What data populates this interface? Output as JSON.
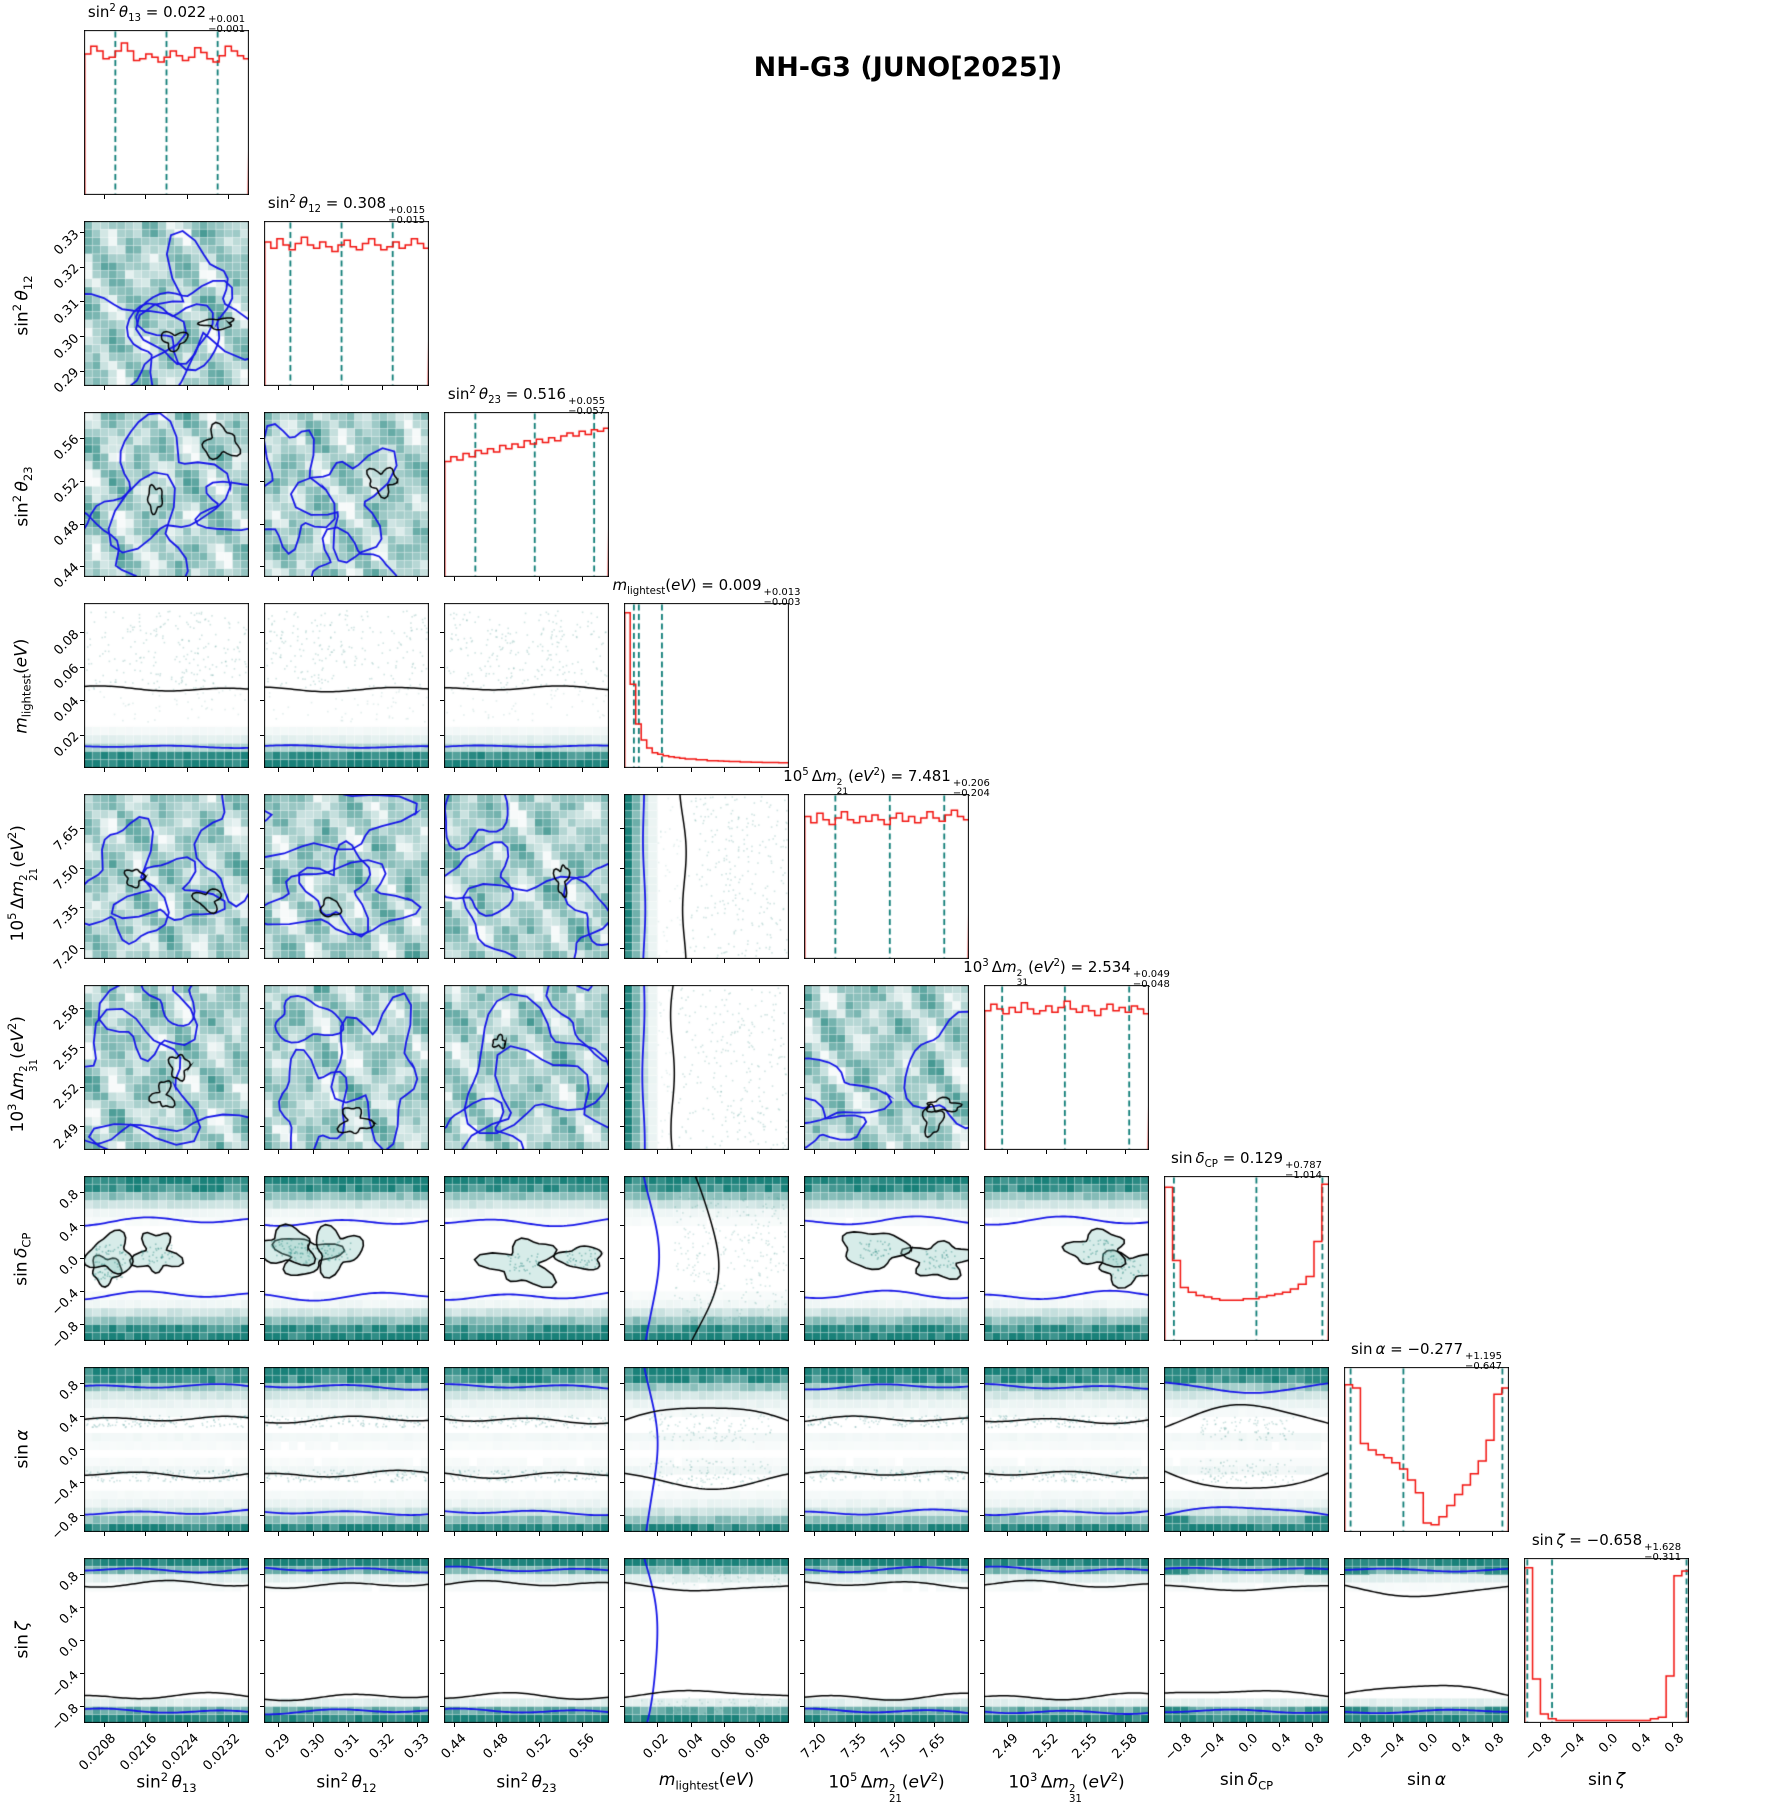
{
  "figure": {
    "title": "NH-G3 (JUNO[2025])"
  },
  "chart_data": {
    "type": "corner_plot",
    "title": "NH-G3 (JUNO[2025])",
    "n_params": 9,
    "legend": "none",
    "grid": "per-panel pixel grid",
    "colors": {
      "hist_line": "#f2120e",
      "quantile_dash": "#0e7d77",
      "contour_outer": "#1717e8",
      "contour_inner": "#000000",
      "density_dark": "#0d7a72",
      "scatter": "rgba(23,125,117,0.30)",
      "background": "#ffffff"
    },
    "groups": {
      "mosaic_params": [
        0,
        1,
        2,
        4,
        5
      ],
      "mass_param": 3,
      "sine_params": [
        6,
        7,
        8
      ]
    },
    "parameters": [
      {
        "key": "sin2theta13",
        "label_text": "sin²θ13",
        "label_html": "sin<sup>2</sup>&#8201;<i>θ</i><sub>13</sub>",
        "estimate": "0.022",
        "plus": "+0.001",
        "minus": "−0.001",
        "range": [
          0.0204,
          0.0236
        ],
        "tick_labels": [
          "0.0208",
          "0.0216",
          "0.0224",
          "0.0232"
        ],
        "tick_fracs": [
          0.125,
          0.375,
          0.625,
          0.875
        ],
        "quantile_fracs": [
          0.19,
          0.5,
          0.81
        ],
        "hist": [
          0.88,
          0.93,
          0.9,
          0.85,
          0.86,
          0.9,
          0.95,
          0.9,
          0.84,
          0.85,
          0.88,
          0.86,
          0.83,
          0.86,
          0.9,
          0.87,
          0.84,
          0.86,
          0.92,
          0.89,
          0.85,
          0.83,
          0.87,
          0.93,
          0.9,
          0.87,
          0.85
        ]
      },
      {
        "key": "sin2theta12",
        "label_text": "sin²θ12",
        "label_html": "sin<sup>2</sup>&#8201;<i>θ</i><sub>12</sub>",
        "estimate": "0.308",
        "plus": "+0.015",
        "minus": "−0.015",
        "range": [
          0.2855,
          0.3335
        ],
        "tick_labels": [
          "0.29",
          "0.30",
          "0.31",
          "0.32",
          "0.33"
        ],
        "tick_fracs": [
          0.09,
          0.3,
          0.51,
          0.72,
          0.93
        ],
        "quantile_fracs": [
          0.16,
          0.47,
          0.78
        ],
        "hist": [
          0.9,
          0.86,
          0.92,
          0.88,
          0.85,
          0.89,
          0.93,
          0.88,
          0.86,
          0.9,
          0.87,
          0.84,
          0.88,
          0.91,
          0.87,
          0.85,
          0.89,
          0.92,
          0.88,
          0.85,
          0.87,
          0.9,
          0.86,
          0.88,
          0.92,
          0.89,
          0.86
        ]
      },
      {
        "key": "sin2theta23",
        "label_text": "sin²θ23",
        "label_html": "sin<sup>2</sup>&#8201;<i>θ</i><sub>23</sub>",
        "estimate": "0.516",
        "plus": "+0.055",
        "minus": "−0.057",
        "range": [
          0.43,
          0.585
        ],
        "tick_labels": [
          "0.44",
          "0.48",
          "0.52",
          "0.56"
        ],
        "tick_fracs": [
          0.065,
          0.32,
          0.58,
          0.84
        ],
        "quantile_fracs": [
          0.19,
          0.55,
          0.91
        ],
        "hist": [
          0.72,
          0.75,
          0.73,
          0.77,
          0.75,
          0.79,
          0.77,
          0.8,
          0.78,
          0.82,
          0.8,
          0.83,
          0.81,
          0.85,
          0.83,
          0.86,
          0.84,
          0.87,
          0.85,
          0.88,
          0.9,
          0.88,
          0.91,
          0.89,
          0.92,
          0.91,
          0.93
        ]
      },
      {
        "key": "mlightest",
        "label_text": "m_lightest(eV)",
        "label_html": "<i>m</i><sub>lightest</sub>(<i>eV</i>)",
        "estimate": "0.009",
        "plus": "+0.013",
        "minus": "−0.003",
        "range": [
          0.0,
          0.097
        ],
        "tick_labels": [
          "0.02",
          "0.04",
          "0.06",
          "0.08"
        ],
        "tick_fracs": [
          0.2,
          0.41,
          0.61,
          0.82
        ],
        "quantile_fracs": [
          0.06,
          0.09,
          0.23
        ],
        "hist": [
          0.97,
          0.52,
          0.27,
          0.17,
          0.12,
          0.09,
          0.08,
          0.07,
          0.065,
          0.06,
          0.055,
          0.05,
          0.05,
          0.045,
          0.045,
          0.04,
          0.04,
          0.038,
          0.036,
          0.035,
          0.034,
          0.032,
          0.031,
          0.03,
          0.03,
          0.029,
          0.028,
          0.028,
          0.027,
          0.026
        ]
      },
      {
        "key": "dm221",
        "label_text": "10^5 Δm²21(eV²)",
        "label_html": "10<sup>5</sup>&#8201;Δ<i>m</i><span class=\"ss\"><span>2</span><span>21</span></span>(<i>eV</i><sup>2</sup>)",
        "estimate": "7.481",
        "plus": "+0.206",
        "minus": "−0.204",
        "range": [
          7.16,
          7.78
        ],
        "tick_labels": [
          "7.20",
          "7.35",
          "7.50",
          "7.65"
        ],
        "tick_fracs": [
          0.065,
          0.31,
          0.55,
          0.79
        ],
        "quantile_fracs": [
          0.19,
          0.52,
          0.85
        ],
        "hist": [
          0.89,
          0.85,
          0.91,
          0.87,
          0.84,
          0.88,
          0.92,
          0.87,
          0.85,
          0.89,
          0.86,
          0.9,
          0.87,
          0.84,
          0.88,
          0.91,
          0.86,
          0.89,
          0.85,
          0.88,
          0.92,
          0.88,
          0.86,
          0.9,
          0.93,
          0.89,
          0.87
        ]
      },
      {
        "key": "dm231",
        "label_text": "10^3 Δm²31(eV²)",
        "label_html": "10<sup>3</sup>&#8201;Δ<i>m</i><span class=\"ss\"><span>2</span><span>31</span></span>(<i>eV</i><sup>2</sup>)",
        "estimate": "2.534",
        "plus": "+0.049",
        "minus": "−0.048",
        "range": [
          2.4795,
          2.5905
        ],
        "tick_labels": [
          "2.49",
          "2.52",
          "2.55",
          "2.58"
        ],
        "tick_fracs": [
          0.14,
          0.38,
          0.62,
          0.86
        ],
        "quantile_fracs": [
          0.11,
          0.49,
          0.88
        ],
        "hist": [
          0.87,
          0.91,
          0.88,
          0.85,
          0.89,
          0.86,
          0.92,
          0.88,
          0.85,
          0.87,
          0.9,
          0.86,
          0.89,
          0.93,
          0.88,
          0.86,
          0.9,
          0.87,
          0.84,
          0.88,
          0.91,
          0.87,
          0.89,
          0.86,
          0.9,
          0.88,
          0.85
        ]
      },
      {
        "key": "sindcp",
        "label_text": "sin δCP",
        "label_html": "sin&#8201;<i>δ</i><sub>CP</sub>",
        "estimate": "0.129",
        "plus": "+0.787",
        "minus": "−1.014",
        "range": [
          -1.0,
          1.0
        ],
        "tick_labels": [
          "−0.8",
          "−0.4",
          "0.0",
          "0.4",
          "0.8"
        ],
        "tick_fracs": [
          0.1,
          0.3,
          0.5,
          0.7,
          0.9
        ],
        "quantile_fracs": [
          0.06,
          0.56,
          0.96
        ],
        "hist": [
          0.96,
          0.5,
          0.33,
          0.3,
          0.28,
          0.27,
          0.26,
          0.25,
          0.25,
          0.25,
          0.26,
          0.26,
          0.27,
          0.28,
          0.29,
          0.3,
          0.32,
          0.35,
          0.4,
          0.62,
          0.98
        ],
        "band_profile": [
          0.95,
          0.8,
          0.45,
          0.2,
          0.06,
          0.03,
          0.02,
          0.02,
          0.02,
          0.02,
          0.02,
          0.02,
          0.02,
          0.02,
          0.03,
          0.06,
          0.2,
          0.45,
          0.8,
          0.95
        ],
        "contours": {
          "blue": [
            0.45,
            -0.45
          ],
          "black": "blobs"
        }
      },
      {
        "key": "sinalpha",
        "label_text": "sin α",
        "label_html": "sin&#8201;<i>α</i>",
        "estimate": "−0.277",
        "plus": "+1.195",
        "minus": "−0.647",
        "range": [
          -1.0,
          1.0
        ],
        "tick_labels": [
          "−0.8",
          "−0.4",
          "0.0",
          "0.4",
          "0.8"
        ],
        "tick_fracs": [
          0.1,
          0.3,
          0.5,
          0.7,
          0.9
        ],
        "quantile_fracs": [
          0.04,
          0.36,
          0.96
        ],
        "hist": [
          0.92,
          0.9,
          0.55,
          0.51,
          0.48,
          0.46,
          0.43,
          0.39,
          0.32,
          0.24,
          0.05,
          0.04,
          0.09,
          0.16,
          0.23,
          0.29,
          0.36,
          0.44,
          0.57,
          0.86,
          0.9
        ],
        "band_profile": [
          0.92,
          0.8,
          0.4,
          0.18,
          0.08,
          0.04,
          0.02,
          0.02,
          0.05,
          0.03,
          0.02,
          0.03,
          0.06,
          0.02,
          0.02,
          0.04,
          0.08,
          0.2,
          0.45,
          0.9
        ],
        "contours": {
          "blue": [
            0.76,
            -0.76
          ],
          "black": [
            0.36,
            -0.3
          ]
        }
      },
      {
        "key": "sinzeta",
        "label_text": "sin ζ",
        "label_html": "sin&#8201;<i>ζ</i>",
        "estimate": "−0.658",
        "plus": "+1.628",
        "minus": "−0.311",
        "range": [
          -1.0,
          1.0
        ],
        "tick_labels": [
          "−0.8",
          "−0.4",
          "0.0",
          "0.4",
          "0.8"
        ],
        "tick_fracs": [
          0.1,
          0.3,
          0.5,
          0.7,
          0.9
        ],
        "quantile_fracs": [
          0.02,
          0.17,
          0.985
        ],
        "hist": [
          0.97,
          0.27,
          0.05,
          0.02,
          0.01,
          0.01,
          0.01,
          0.01,
          0.01,
          0.01,
          0.01,
          0.01,
          0.01,
          0.01,
          0.01,
          0.01,
          0.02,
          0.03,
          0.29,
          0.92,
          0.95
        ],
        "band_profile": [
          0.95,
          0.55,
          0.12,
          0.03,
          0.01,
          0.01,
          0.01,
          0.01,
          0.01,
          0.01,
          0.01,
          0.01,
          0.01,
          0.01,
          0.01,
          0.01,
          0.02,
          0.12,
          0.6,
          0.95
        ],
        "contours": {
          "blue": [
            0.86,
            -0.86
          ],
          "black": [
            0.68,
            -0.68
          ]
        }
      }
    ]
  }
}
